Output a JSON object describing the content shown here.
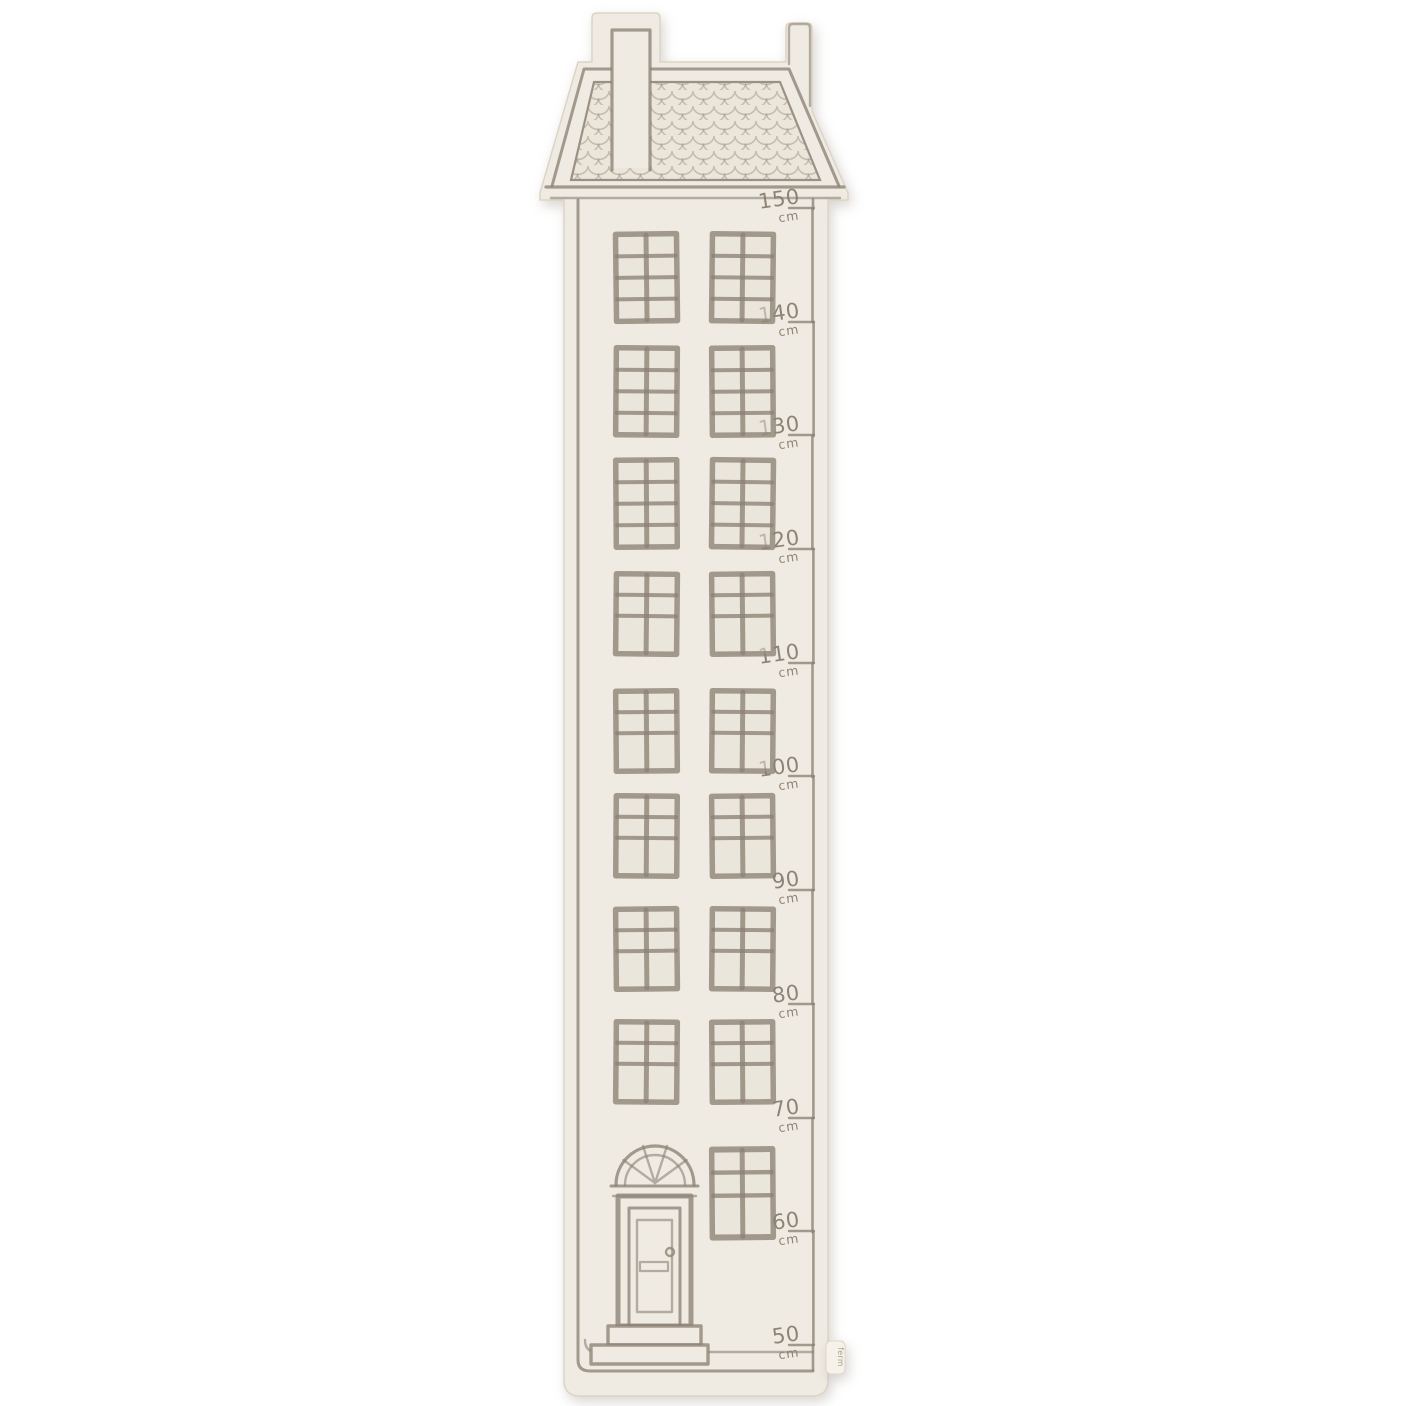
{
  "scene": {
    "type": "product-photo",
    "subject": "house-shaped fabric growth chart hanging measure",
    "background_color": "#ffffff"
  },
  "palette": {
    "fabric": "#f0ebe2",
    "outline": "#8c8175",
    "window_pane": "#e7e1d6",
    "tag_fabric": "#f6f2ea"
  },
  "ruler": {
    "unit": "cm",
    "values": [
      "150",
      "140",
      "130",
      "120",
      "110",
      "100",
      "90",
      "80",
      "70",
      "60",
      "50"
    ]
  },
  "house": {
    "roof": "hip roof with scalloped shingles, chimney at left, hanging loop at right",
    "floors_with_eight_pane_windows": 3,
    "floors_with_six_pane_windows": 5,
    "ground_floor": "panelled front door with arched fanlight and two steps, one six-pane window"
  },
  "tag": {
    "label": "ferm"
  }
}
